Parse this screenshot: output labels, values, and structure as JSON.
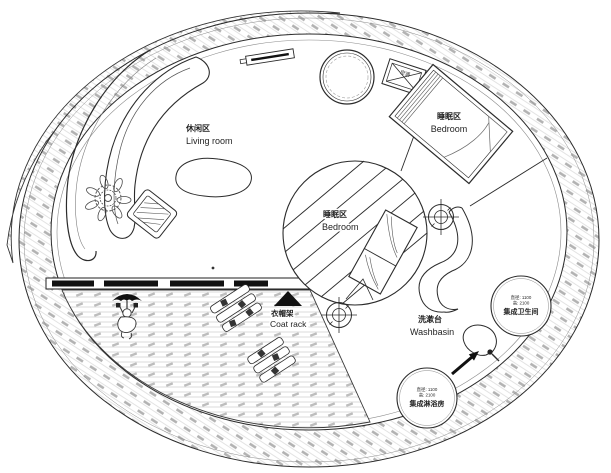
{
  "plan_title": "Circular tiny-house floor plan",
  "colors": {
    "line": "#2b2b2b",
    "light_line": "#8a8a8a",
    "hatch_line": "#d6d6d6",
    "hatch_dash": "#b0b0b0",
    "background": "#ffffff"
  },
  "areas": {
    "living_room": {
      "zh": "休闲区",
      "en": "Living room"
    },
    "bedroom_upper": {
      "zh": "睡眠区",
      "en": "Bedroom"
    },
    "bedroom_center": {
      "zh": "睡眠区",
      "en": "Bedroom"
    },
    "coat_rack": {
      "zh": "衣帽架",
      "en": "Coat rack"
    },
    "washbasin": {
      "zh": "洗漱台",
      "en": "Washbasin"
    }
  },
  "pods": {
    "bathroom": {
      "name": "集成卫生间",
      "diameter": "直径: 1100",
      "height": "高: 2100"
    },
    "shower": {
      "name": "集成淋浴房",
      "diameter": "直径: 1100",
      "height": "高: 2100"
    }
  },
  "equipment": {
    "ac_label": "空调"
  }
}
